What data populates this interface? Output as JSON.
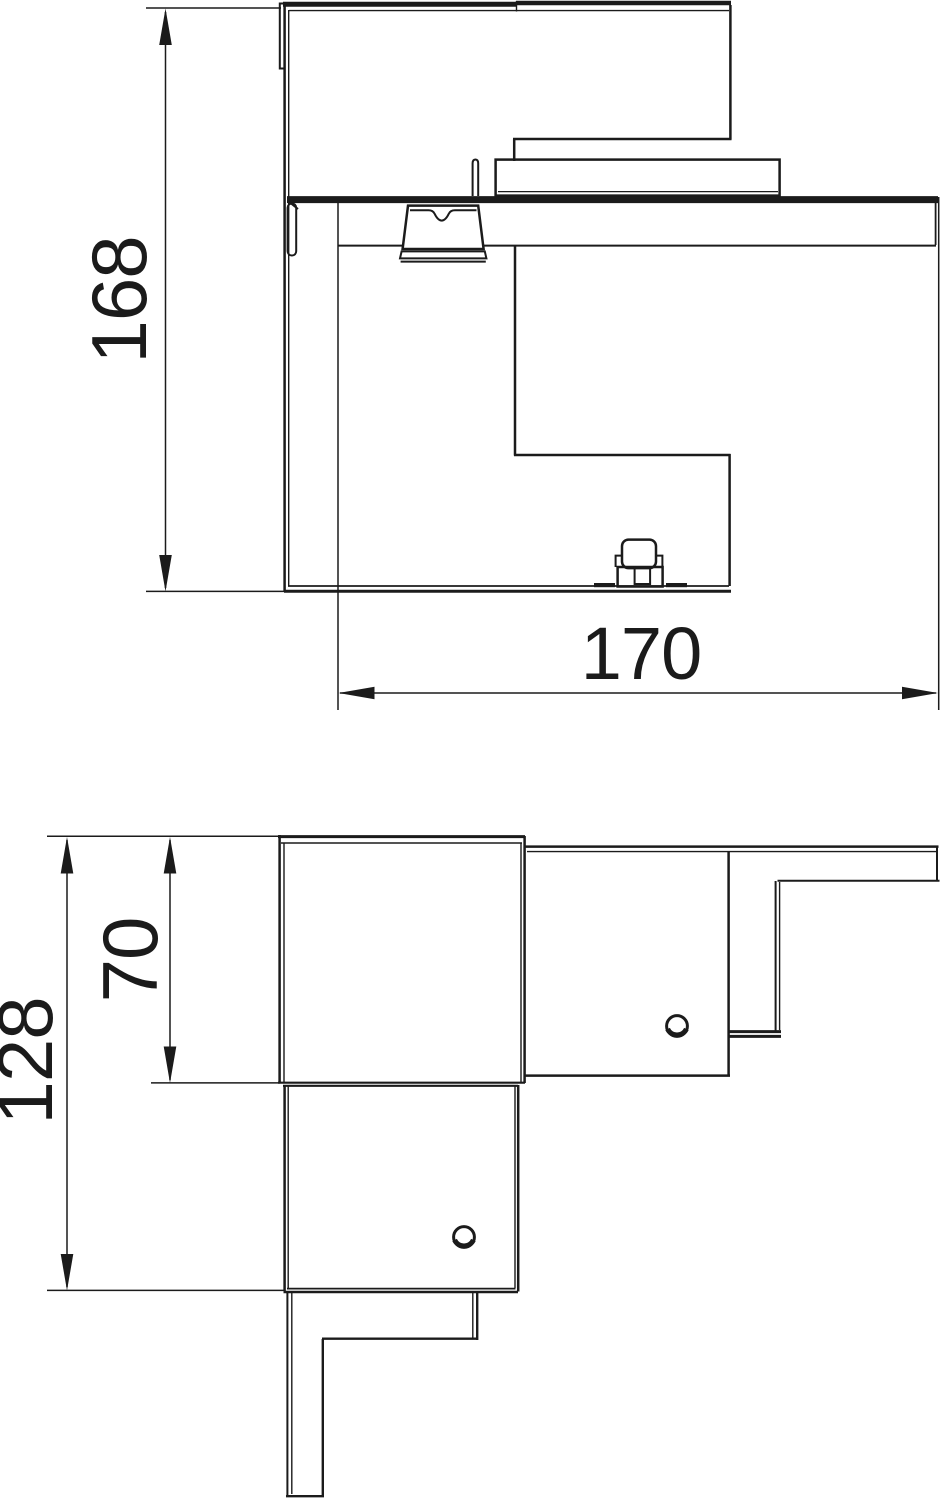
{
  "drawing_type": "technical-dimension-drawing",
  "colors": {
    "line": "#1b1b1b",
    "background": "#ffffff"
  },
  "views": {
    "top": {
      "name": "plan-view-of-corner-piece",
      "dimensions": {
        "height": {
          "value": "168"
        },
        "width": {
          "value": "170"
        }
      }
    },
    "bottom": {
      "name": "elevation-view-of-corner-piece",
      "dimensions": {
        "overall_height": {
          "value": "128"
        },
        "upper_height": {
          "value": "70"
        }
      }
    }
  }
}
